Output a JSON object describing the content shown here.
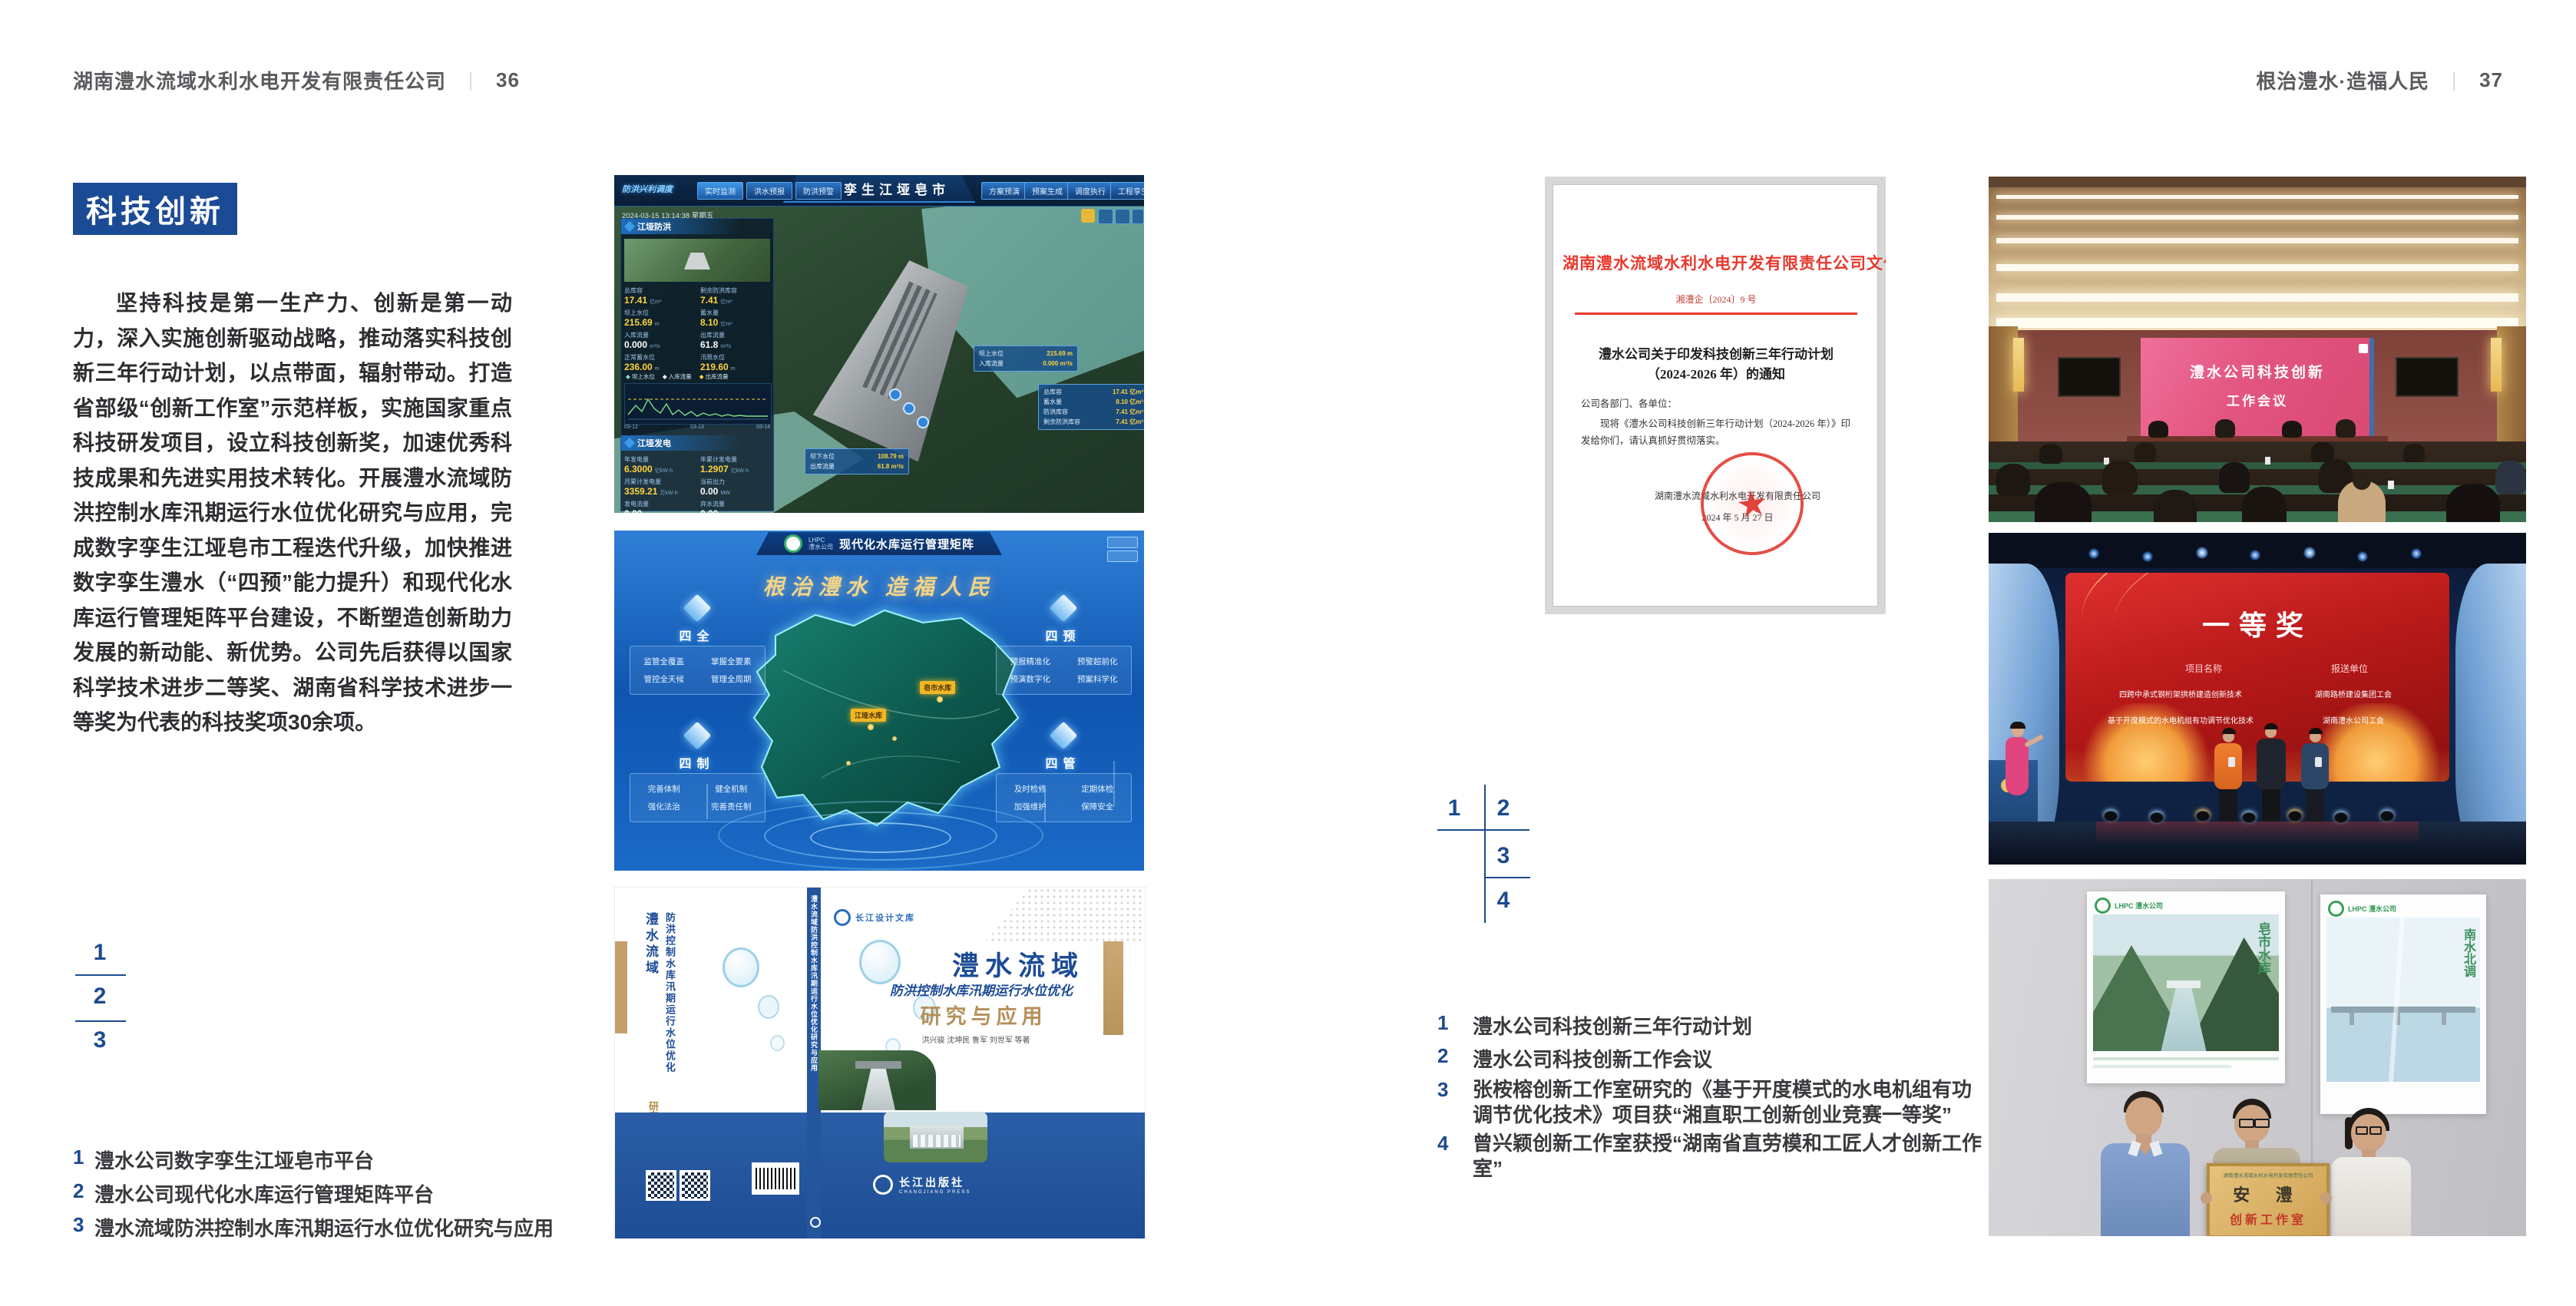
{
  "colors": {
    "accent_blue": "#1c4b96",
    "caption_blue": "#1d4a8f",
    "doc_red": "#e8382c",
    "slogan_gold": "#f3d488",
    "marker_yellow": "#f2b624"
  },
  "spread": {
    "left_header": {
      "company": "湖南澧水流域水利水电开发有限责任公司",
      "divider": "｜",
      "page": "36"
    },
    "right_header": {
      "slogan": "根治澧水·造福人民",
      "divider": "｜",
      "page": "37"
    }
  },
  "left_page": {
    "section_title": "科技创新",
    "body": "坚持科技是第一生产力、创新是第一动力，深入实施创新驱动战略，推动落实科技创新三年行动计划，以点带面，辐射带动。打造省部级“创新工作室”示范样板，实施国家重点科技研发项目，设立科技创新奖，加速优秀科技成果和先进实用技术转化。开展澧水流域防洪控制水库汛期运行水位优化研究与应用，完成数字孪生江垭皂市工程迭代升级，加快推进数字孪生澧水（“四预”能力提升）和现代化水库运行管理矩阵平台建设，不断塑造创新助力发展的新动能、新优势。公司先后获得以国家科学技术进步二等奖、湖南省科学技术进步一等奖为代表的科技奖项30余项。",
    "index_nums": [
      "1",
      "2",
      "3"
    ],
    "captions": [
      {
        "num": "1",
        "text": "澧水公司数字孪生江垭皂市平台"
      },
      {
        "num": "2",
        "text": "澧水公司现代化水库运行管理矩阵平台"
      },
      {
        "num": "3",
        "text": "澧水流域防洪控制水库汛期运行水位优化研究与应用"
      }
    ]
  },
  "right_page": {
    "index_nums": [
      "1",
      "2",
      "3",
      "4"
    ],
    "captions": [
      {
        "num": "1",
        "text": "澧水公司科技创新三年行动计划"
      },
      {
        "num": "2",
        "text": "澧水公司科技创新工作会议"
      },
      {
        "num": "3",
        "text": "张桉榕创新工作室研究的《基于开度模式的水电机组有功调节优化技术》项目获“湘直职工创新创业竞赛一等奖”"
      },
      {
        "num": "4",
        "text": "曾兴颖创新工作室获授“湖南省直劳模和工匠人才创新工作室”"
      }
    ]
  },
  "twin_platform": {
    "title": "数字孪生江垭皂市",
    "mode_label": "防洪兴利调度",
    "tabs_left": [
      "实时监测",
      "洪水预报",
      "防洪预警"
    ],
    "tabs_right": [
      "方案预演",
      "预案生成",
      "调度执行",
      "工程孪生"
    ],
    "timestamp": "2024-03-15 13:14:38 星期五",
    "flood_panel": {
      "title": "江垭防洪",
      "stats": [
        {
          "label": "总库容",
          "value": "17.41",
          "unit": "亿m³"
        },
        {
          "label": "剩余防洪库容",
          "value": "7.41",
          "unit": "亿m³"
        },
        {
          "label": "坝上水位",
          "value": "215.69",
          "unit": "m"
        },
        {
          "label": "蓄水量",
          "value": "8.10",
          "unit": "亿m³"
        },
        {
          "label": "入库流量",
          "value": "0.000",
          "unit": "m³/s"
        },
        {
          "label": "出库流量",
          "value": "61.8",
          "unit": "m³/s"
        },
        {
          "label": "正常蓄水位",
          "value": "236.00",
          "unit": "m"
        },
        {
          "label": "汛限水位",
          "value": "219.60",
          "unit": "m"
        }
      ],
      "legend": [
        "坝上水位",
        "入库流量",
        "出库流量"
      ],
      "x_ticks": [
        "03-12",
        "03-13",
        "03-14"
      ]
    },
    "power_panel": {
      "title": "江垭发电",
      "stats": [
        {
          "label": "年发电量",
          "value": "6.3000",
          "unit": "亿kW·h"
        },
        {
          "label": "年累计发电量",
          "value": "1.2907",
          "unit": "亿kW·h"
        },
        {
          "label": "月累计发电量",
          "value": "3359.21",
          "unit": "万kW·h"
        },
        {
          "label": "当前出力",
          "value": "0.00",
          "unit": "MW"
        },
        {
          "label": "发电流量",
          "value": "0.00",
          "unit": "m³/s"
        },
        {
          "label": "弃水流量",
          "value": "0.00",
          "unit": "m³/s"
        }
      ]
    },
    "tooltip_up": [
      {
        "label": "坝上水位",
        "value": "215.69 m"
      },
      {
        "label": "入库流量",
        "value": "0.000 m³/s"
      }
    ],
    "tooltip_right": [
      {
        "label": "总库容",
        "value": "17.41 亿m³"
      },
      {
        "label": "蓄水量",
        "value": "8.10 亿m³"
      },
      {
        "label": "防洪库容",
        "value": "7.41 亿m³"
      },
      {
        "label": "剩余防洪库容",
        "value": "7.41 亿m³"
      }
    ],
    "tooltip_down": [
      {
        "label": "坝下水位",
        "value": "108.79 m"
      },
      {
        "label": "出库流量",
        "value": "61.8 m³/s"
      }
    ]
  },
  "matrix_platform": {
    "logo_text": "LHPC",
    "logo_sub": "澧水公司",
    "title": "现代化水库运行管理矩阵",
    "slogan": "根治澧水  造福人民",
    "panels": [
      {
        "title": "四全",
        "items": [
          "监管全覆盖",
          "掌握全要素",
          "管控全天候",
          "管理全周期"
        ]
      },
      {
        "title": "四预",
        "items": [
          "预报精准化",
          "预警超前化",
          "预演数字化",
          "预案科学化"
        ]
      },
      {
        "title": "四制",
        "items": [
          "完善体制",
          "健全机制",
          "强化法治",
          "完善责任制"
        ]
      },
      {
        "title": "四管",
        "items": [
          "及时检修",
          "定期体检",
          "加强维护",
          "保障安全"
        ]
      }
    ],
    "markers": [
      "皂市水库",
      "江垭水库"
    ]
  },
  "book": {
    "series": "长江设计文库",
    "title_main": "澧水流域",
    "title_sub": "防洪控制水库汛期运行水位优化",
    "title_tail": "研究与应用",
    "authors": "洪兴骏  沈坤民  鲁军  刘世军  等著",
    "spine_title": "澧水流域防洪控制水库汛期运行水位优化研究与应用",
    "back_title_1": "澧水流域",
    "back_title_2": "防洪控制水库汛期运行水位优化",
    "back_title_3": "研究与应用",
    "publisher": "长江出版社",
    "publisher_en": "CHANGJIANG PRESS"
  },
  "document": {
    "header": "湖南澧水流域水利水电开发有限责任公司文件",
    "doc_no": "湘澧企〔2024〕9 号",
    "title_line1": "澧水公司关于印发科技创新三年行动计划",
    "title_line2": "（2024-2026 年）的通知",
    "salutation": "公司各部门、各单位：",
    "body_line1": "现将《澧水公司科技创新三年行动计划（2024-2026 年）》印",
    "body_line2": "发给你们，请认真抓好贯彻落实。",
    "signer": "湖南澧水流域水利水电开发有限责任公司",
    "date": "2024 年 5 月 27 日"
  },
  "meeting": {
    "screen_line1": "澧水公司科技创新",
    "screen_line2": "工作会议"
  },
  "award": {
    "title": "一等奖",
    "col_project": "项目名称",
    "col_org": "报送单位",
    "rows": [
      {
        "project": "四跨中承式钢桁架拱桥建造创新技术",
        "org": "湖南路桥建设集团工会"
      },
      {
        "project": "基于开度模式的水电机组有功调节优化技术",
        "org": "湖南澧水公司工会"
      }
    ]
  },
  "workshop": {
    "plaque_org": "湖南澧水流域水利水电开发有限责任公司",
    "plaque_name": "安  澧",
    "plaque_sub": "创新工作室",
    "poster_left_logo": "LHPC 澧水公司",
    "poster_left_title": "皂市水库",
    "poster_right_logo": "LHPC 澧水公司",
    "poster_right_title": "南水北调"
  }
}
